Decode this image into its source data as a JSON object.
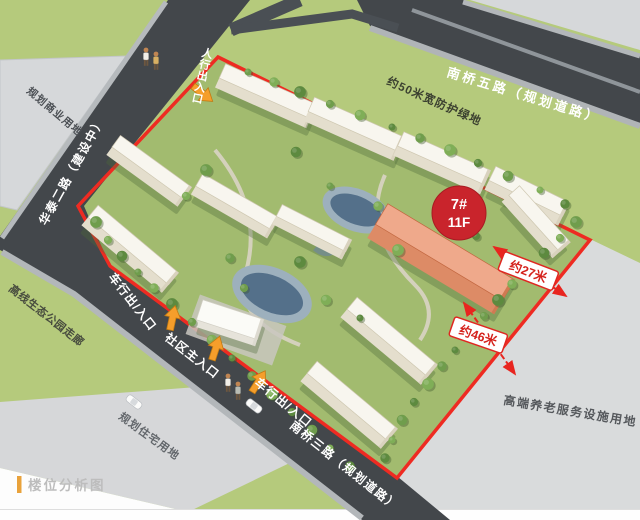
{
  "figure": {
    "caption": "楼位分析图",
    "highlight_building": {
      "number": "7#",
      "floors": "11F"
    },
    "dimensions": {
      "east": "约27米",
      "south": "约46米"
    },
    "roads": {
      "north": "南桥五路（规划道路）",
      "west": "华泰二路（建设中）",
      "south": "南桥三路（规划道路）"
    },
    "parcels": {
      "northwest": "规划商业用地",
      "north_buffer": "约50米宽防护绿地",
      "park": "高线生态公园走廊",
      "southwest": "规划住宅用地",
      "southeast": "高端养老服务设施用地"
    },
    "entrances": {
      "pedestrian": "人行出入口",
      "vehicle_west": "车行出/入口",
      "main": "社区主入口",
      "vehicle_south": "车行出/入口"
    },
    "colors": {
      "boundary_red": "#EE2B22",
      "badge_red": "#C9242C",
      "arrow_orange": "#F59E2B",
      "highlight_fill": "#EFA98B",
      "road_gray": "#43474B",
      "grass_green": "#B5CA7C",
      "parcel_gray": "#D6D8DA",
      "caption_accent": "#E9A23B"
    }
  }
}
